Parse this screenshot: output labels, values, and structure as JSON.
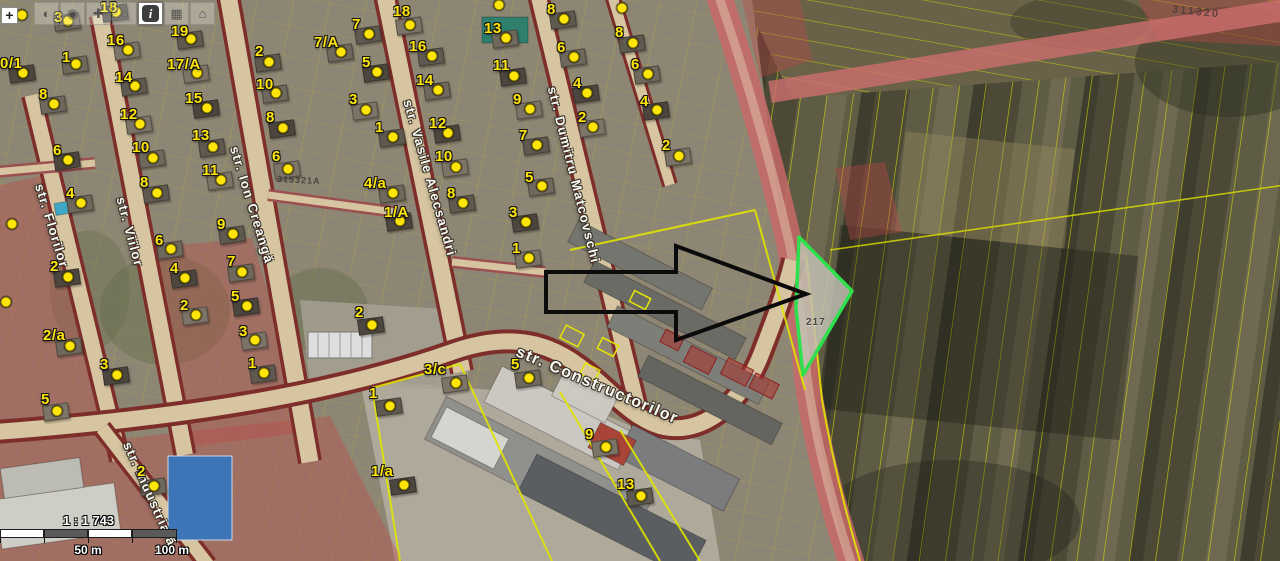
{
  "toolbar": {
    "zoom_in_label": "+",
    "buttons": [
      {
        "name": "pan-tool",
        "glyph": "◐",
        "active": false
      },
      {
        "name": "select-tool",
        "glyph": "◉",
        "active": false
      },
      {
        "name": "draw-tool",
        "glyph": "✚",
        "active": false
      },
      {
        "name": "measure-tool",
        "glyph": "◌",
        "active": false
      },
      {
        "name": "info-tool",
        "glyph": "i",
        "active": true
      },
      {
        "name": "legend-tool",
        "glyph": "▦",
        "active": false
      },
      {
        "name": "print-tool",
        "glyph": "⌂",
        "active": false
      }
    ]
  },
  "scale": {
    "ratio": "1 : 1 743",
    "half": "50 m",
    "full": "100 m"
  },
  "colors": {
    "marker_yellow": "#ffe50a",
    "parcel_line_yellow": "#e3e600",
    "highlight_green": "#2ee04e",
    "road_fill": "#d6c5a0",
    "road_casing": "#7e2e2a",
    "zone_overlay_red": "rgba(190,70,70,0.38)"
  },
  "map": {
    "street_labels": [
      {
        "text": "str. Florilor",
        "x": 52,
        "y": 226,
        "rot": 73,
        "size": 13
      },
      {
        "text": "str. Viilor",
        "x": 130,
        "y": 232,
        "rot": 75,
        "size": 13
      },
      {
        "text": "str. Ion Creangă",
        "x": 252,
        "y": 205,
        "rot": 73,
        "size": 13
      },
      {
        "text": "str. Vasile Alecsandri",
        "x": 430,
        "y": 178,
        "rot": 74,
        "size": 13
      },
      {
        "text": "str. Dumitru Matcovschi",
        "x": 574,
        "y": 175,
        "rot": 76,
        "size": 13
      },
      {
        "text": "str. Constructorilor",
        "x": 597,
        "y": 386,
        "rot": 23,
        "size": 16
      },
      {
        "text": "str. Industrială",
        "x": 150,
        "y": 494,
        "rot": 66,
        "size": 13
      }
    ],
    "faint_labels": [
      {
        "text": "315321A",
        "x": 277,
        "y": 175,
        "rot": 3,
        "cls": "cad"
      },
      {
        "text": "311320",
        "x": 1172,
        "y": 6,
        "rot": 6,
        "cls": "cad-big"
      },
      {
        "text": "217",
        "x": 806,
        "y": 317,
        "rot": 0,
        "cls": "emboss"
      }
    ],
    "markers": [
      {
        "t": "",
        "x": 22,
        "y": 15
      },
      {
        "t": "3",
        "lx": 54,
        "ly": 10,
        "x": 68,
        "y": 21
      },
      {
        "t": "18",
        "lx": 100,
        "ly": 0,
        "x": 116,
        "y": 12
      },
      {
        "t": "16",
        "lx": 107,
        "ly": 33,
        "x": 128,
        "y": 50
      },
      {
        "t": "19",
        "lx": 171,
        "ly": 24,
        "x": 191,
        "y": 39
      },
      {
        "t": "1",
        "lx": 62,
        "ly": 50,
        "x": 76,
        "y": 64
      },
      {
        "t": "0/1",
        "lx": 0,
        "ly": 56,
        "x": 23,
        "y": 73
      },
      {
        "t": "17/A",
        "lx": 167,
        "ly": 57,
        "x": 197,
        "y": 73
      },
      {
        "t": "14",
        "lx": 115,
        "ly": 70,
        "x": 135,
        "y": 86
      },
      {
        "t": "8",
        "lx": 39,
        "ly": 87,
        "x": 54,
        "y": 104
      },
      {
        "t": "15",
        "lx": 185,
        "ly": 91,
        "x": 207,
        "y": 108
      },
      {
        "t": "12",
        "lx": 120,
        "ly": 107,
        "x": 140,
        "y": 124
      },
      {
        "t": "13",
        "lx": 192,
        "ly": 128,
        "x": 213,
        "y": 147
      },
      {
        "t": "10",
        "lx": 132,
        "ly": 140,
        "x": 153,
        "y": 158
      },
      {
        "t": "6",
        "lx": 53,
        "ly": 143,
        "x": 68,
        "y": 160
      },
      {
        "t": "11",
        "lx": 202,
        "ly": 163,
        "x": 221,
        "y": 180
      },
      {
        "t": "8",
        "lx": 140,
        "ly": 175,
        "x": 157,
        "y": 193
      },
      {
        "t": "4",
        "lx": 66,
        "ly": 186,
        "x": 81,
        "y": 203
      },
      {
        "t": "2",
        "lx": 50,
        "ly": 259,
        "x": 68,
        "y": 277
      },
      {
        "t": "",
        "x": 12,
        "y": 224
      },
      {
        "t": "",
        "x": 6,
        "y": 302
      },
      {
        "t": "2/a",
        "lx": 43,
        "ly": 328,
        "x": 70,
        "y": 346
      },
      {
        "t": "3",
        "lx": 100,
        "ly": 357,
        "x": 117,
        "y": 375
      },
      {
        "t": "5",
        "lx": 41,
        "ly": 392,
        "x": 57,
        "y": 411
      },
      {
        "t": "2",
        "lx": 255,
        "ly": 44,
        "x": 269,
        "y": 62
      },
      {
        "t": "10",
        "lx": 256,
        "ly": 77,
        "x": 276,
        "y": 93
      },
      {
        "t": "8",
        "lx": 266,
        "ly": 110,
        "x": 283,
        "y": 128
      },
      {
        "t": "6",
        "lx": 272,
        "ly": 149,
        "x": 288,
        "y": 169
      },
      {
        "t": "9",
        "lx": 217,
        "ly": 217,
        "x": 233,
        "y": 234
      },
      {
        "t": "7",
        "lx": 227,
        "ly": 254,
        "x": 242,
        "y": 272
      },
      {
        "t": "5",
        "lx": 231,
        "ly": 289,
        "x": 247,
        "y": 306
      },
      {
        "t": "3",
        "lx": 239,
        "ly": 324,
        "x": 255,
        "y": 340
      },
      {
        "t": "1",
        "lx": 248,
        "ly": 356,
        "x": 264,
        "y": 373
      },
      {
        "t": "6",
        "lx": 155,
        "ly": 233,
        "x": 171,
        "y": 249
      },
      {
        "t": "4",
        "lx": 170,
        "ly": 261,
        "x": 185,
        "y": 278
      },
      {
        "t": "2",
        "lx": 180,
        "ly": 298,
        "x": 196,
        "y": 315
      },
      {
        "t": "7",
        "lx": 352,
        "ly": 17,
        "x": 369,
        "y": 34
      },
      {
        "t": "7/A",
        "lx": 314,
        "ly": 35,
        "x": 341,
        "y": 52
      },
      {
        "t": "5",
        "lx": 362,
        "ly": 55,
        "x": 377,
        "y": 72
      },
      {
        "t": "3",
        "lx": 349,
        "ly": 92,
        "x": 366,
        "y": 110
      },
      {
        "t": "1",
        "lx": 375,
        "ly": 120,
        "x": 393,
        "y": 137
      },
      {
        "t": "4/a",
        "lx": 364,
        "ly": 176,
        "x": 393,
        "y": 193
      },
      {
        "t": "1/A",
        "lx": 384,
        "ly": 205,
        "x": 400,
        "y": 221
      },
      {
        "t": "18",
        "lx": 393,
        "ly": 4,
        "x": 410,
        "y": 25
      },
      {
        "t": "16",
        "lx": 409,
        "ly": 39,
        "x": 432,
        "y": 56
      },
      {
        "t": "14",
        "lx": 416,
        "ly": 73,
        "x": 438,
        "y": 90
      },
      {
        "t": "12",
        "lx": 429,
        "ly": 116,
        "x": 448,
        "y": 133
      },
      {
        "t": "10",
        "lx": 435,
        "ly": 149,
        "x": 456,
        "y": 167
      },
      {
        "t": "8",
        "lx": 447,
        "ly": 186,
        "x": 463,
        "y": 203
      },
      {
        "t": "13",
        "lx": 484,
        "ly": 21,
        "x": 506,
        "y": 38
      },
      {
        "t": "11",
        "lx": 493,
        "ly": 58,
        "x": 514,
        "y": 76
      },
      {
        "t": "9",
        "lx": 513,
        "ly": 92,
        "x": 530,
        "y": 109
      },
      {
        "t": "7",
        "lx": 519,
        "ly": 128,
        "x": 537,
        "y": 145
      },
      {
        "t": "5",
        "lx": 525,
        "ly": 170,
        "x": 542,
        "y": 186
      },
      {
        "t": "3",
        "lx": 509,
        "ly": 205,
        "x": 526,
        "y": 222
      },
      {
        "t": "1",
        "lx": 512,
        "ly": 241,
        "x": 529,
        "y": 258
      },
      {
        "t": "8",
        "lx": 547,
        "ly": 2,
        "x": 564,
        "y": 19
      },
      {
        "t": "6",
        "lx": 557,
        "ly": 40,
        "x": 574,
        "y": 57
      },
      {
        "t": "4",
        "lx": 573,
        "ly": 76,
        "x": 587,
        "y": 93
      },
      {
        "t": "2",
        "lx": 578,
        "ly": 110,
        "x": 593,
        "y": 127
      },
      {
        "t": "8",
        "lx": 615,
        "ly": 25,
        "x": 633,
        "y": 43
      },
      {
        "t": "6",
        "lx": 631,
        "ly": 57,
        "x": 648,
        "y": 74
      },
      {
        "t": "4",
        "lx": 640,
        "ly": 94,
        "x": 657,
        "y": 110
      },
      {
        "t": "2",
        "lx": 662,
        "ly": 138,
        "x": 679,
        "y": 156
      },
      {
        "t": "",
        "x": 499,
        "y": 5
      },
      {
        "t": "",
        "x": 622,
        "y": 8
      },
      {
        "t": "2",
        "lx": 355,
        "ly": 305,
        "x": 372,
        "y": 325
      },
      {
        "t": "3/c",
        "lx": 424,
        "ly": 362,
        "x": 456,
        "y": 383
      },
      {
        "t": "1",
        "lx": 369,
        "ly": 386,
        "x": 390,
        "y": 406
      },
      {
        "t": "5",
        "lx": 511,
        "ly": 357,
        "x": 529,
        "y": 378
      },
      {
        "t": "1/a",
        "lx": 371,
        "ly": 464,
        "x": 404,
        "y": 485
      },
      {
        "t": "9",
        "lx": 585,
        "ly": 427,
        "x": 606,
        "y": 447
      },
      {
        "t": "13",
        "lx": 617,
        "ly": 477,
        "x": 641,
        "y": 496
      },
      {
        "t": "2",
        "lx": 137,
        "ly": 464,
        "x": 154,
        "y": 486
      }
    ]
  }
}
